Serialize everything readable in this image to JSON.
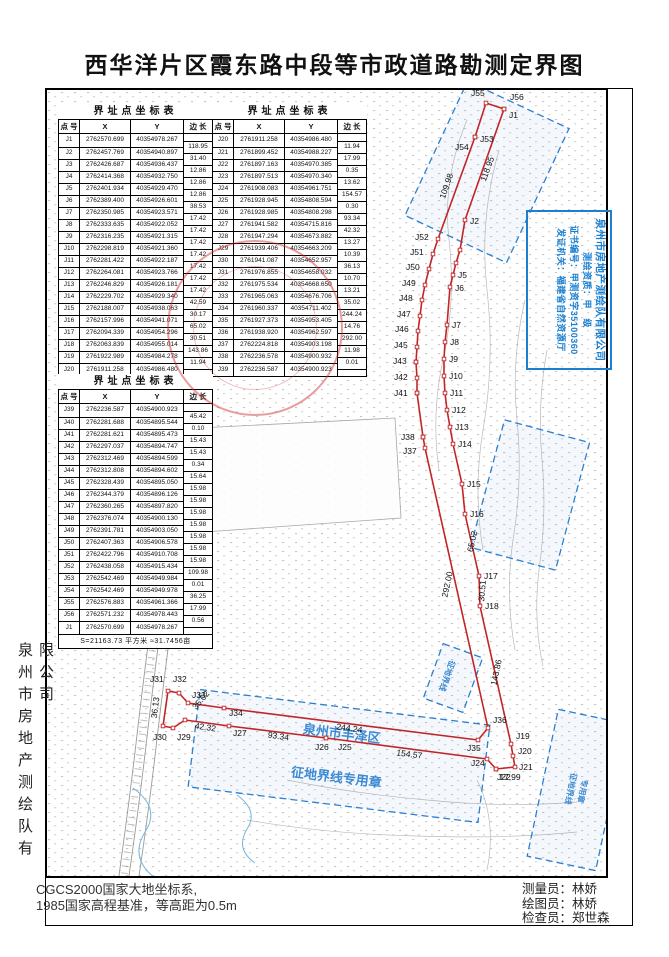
{
  "title": "西华洋片区霞东路中段等市政道路勘测定界图",
  "side_company": "泉州市房地产测绘队有限公司",
  "footnotes": [
    "CGCS2000国家大地坐标系,",
    "1985国家高程基准，等高距为0.5m"
  ],
  "credits": [
    {
      "label": "测量员",
      "name": "林娇"
    },
    {
      "label": "绘图员",
      "name": "林娇"
    },
    {
      "label": "检查员",
      "name": "郑世森"
    }
  ],
  "credits_sep": "：",
  "license_stamp": {
    "company": "泉州市房地产测绘队有限公司",
    "lines": [
      "测绘资质：甲　级",
      "证书编号：甲测资字35100360",
      "发证机关：福建省自然资源厅"
    ],
    "color": "#1a7fd0"
  },
  "tables": [
    {
      "title": "界址点坐标表",
      "headers": [
        "点 号",
        "X",
        "Y",
        "边 长"
      ],
      "points": [
        [
          "J1",
          "2762570.699",
          "40354978.267"
        ],
        [
          "J2",
          "2762457.769",
          "40354940.897"
        ],
        [
          "J3",
          "2762426.687",
          "40354936.437"
        ],
        [
          "J4",
          "2762414.368",
          "40354932.750"
        ],
        [
          "J5",
          "2762401.934",
          "40354929.470"
        ],
        [
          "J6",
          "2762389.400",
          "40354926.601"
        ],
        [
          "J7",
          "2762350.985",
          "40354923.571"
        ],
        [
          "J8",
          "2762333.635",
          "40354922.052"
        ],
        [
          "J9",
          "2762316.235",
          "40354921.315"
        ],
        [
          "J10",
          "2762298.819",
          "40354921.360"
        ],
        [
          "J11",
          "2762281.422",
          "40354922.187"
        ],
        [
          "J12",
          "2762264.081",
          "40354923.766"
        ],
        [
          "J13",
          "2762246.829",
          "40354926.181"
        ],
        [
          "J14",
          "2762229.702",
          "40354929.340"
        ],
        [
          "J15",
          "2762188.007",
          "40354938.063"
        ],
        [
          "J16",
          "2762157.996",
          "40354941.071"
        ],
        [
          "J17",
          "2762094.339",
          "40354954.296"
        ],
        [
          "J18",
          "2762063.839",
          "40354955.014"
        ],
        [
          "J19",
          "2761922.989",
          "40354984.278"
        ],
        [
          "J20",
          "2761911.258",
          "40354986.480"
        ]
      ],
      "lengths": [
        "118.95",
        "31.40",
        "12.86",
        "12.86",
        "12.86",
        "38.53",
        "17.42",
        "17.42",
        "17.42",
        "17.42",
        "17.42",
        "17.42",
        "17.42",
        "42.59",
        "30.17",
        "65.02",
        "30.51",
        "143.86",
        "11.94"
      ]
    },
    {
      "title": "界址点坐标表",
      "headers": [
        "点 号",
        "X",
        "Y",
        "边 长"
      ],
      "points": [
        [
          "J20",
          "2761911.258",
          "40354986.480"
        ],
        [
          "J21",
          "2761899.452",
          "40354988.227"
        ],
        [
          "J22",
          "2761897.163",
          "40354970.385"
        ],
        [
          "J23",
          "2761897.513",
          "40354970.340"
        ],
        [
          "J24",
          "2761908.083",
          "40354961.751"
        ],
        [
          "J25",
          "2761928.945",
          "40354808.594"
        ],
        [
          "J26",
          "2761928.985",
          "40354808.298"
        ],
        [
          "J27",
          "2761941.582",
          "40354715.816"
        ],
        [
          "J28",
          "2761947.294",
          "40354673.882"
        ],
        [
          "J29",
          "2761939.406",
          "40354663.209"
        ],
        [
          "J30",
          "2761941.087",
          "40354652.957"
        ],
        [
          "J31",
          "2761976.855",
          "40354658.032"
        ],
        [
          "J32",
          "2761975.534",
          "40354668.650"
        ],
        [
          "J33",
          "2761965.063",
          "40354676.706"
        ],
        [
          "J34",
          "2761960.337",
          "40354711.402"
        ],
        [
          "J35",
          "2761927.373",
          "40354953.405"
        ],
        [
          "J36",
          "2761938.920",
          "40354962.597"
        ],
        [
          "J37",
          "2762224.818",
          "40354903.198"
        ],
        [
          "J38",
          "2762236.578",
          "40354900.932"
        ],
        [
          "J39",
          "2762236.587",
          "40354900.923"
        ]
      ],
      "lengths": [
        "11.94",
        "17.99",
        "0.35",
        "13.62",
        "154.57",
        "0.30",
        "93.34",
        "42.32",
        "13.27",
        "10.39",
        "36.13",
        "10.70",
        "13.21",
        "35.02",
        "244.24",
        "14.76",
        "292.00",
        "11.98",
        "0.01"
      ]
    },
    {
      "title": "界址点坐标表",
      "headers": [
        "点 号",
        "X",
        "Y",
        "边 长"
      ],
      "points": [
        [
          "J39",
          "2762236.587",
          "40354900.923"
        ],
        [
          "J40",
          "2762281.688",
          "40354895.544"
        ],
        [
          "J41",
          "2762281.621",
          "40354895.473"
        ],
        [
          "J42",
          "2762297.037",
          "40354894.747"
        ],
        [
          "J43",
          "2762312.469",
          "40354894.599"
        ],
        [
          "J44",
          "2762312.808",
          "40354894.602"
        ],
        [
          "J45",
          "2762328.439",
          "40354895.050"
        ],
        [
          "J46",
          "2762344.379",
          "40354896.126"
        ],
        [
          "J47",
          "2762360.265",
          "40354897.820"
        ],
        [
          "J48",
          "2762376.074",
          "40354900.130"
        ],
        [
          "J49",
          "2762391.781",
          "40354903.050"
        ],
        [
          "J50",
          "2762407.363",
          "40354906.578"
        ],
        [
          "J51",
          "2762422.796",
          "40354910.708"
        ],
        [
          "J52",
          "2762438.058",
          "40354915.434"
        ],
        [
          "J53",
          "2762542.469",
          "40354949.984"
        ],
        [
          "J54",
          "2762542.469",
          "40354949.978"
        ],
        [
          "J55",
          "2762576.883",
          "40354961.366"
        ],
        [
          "J56",
          "2762571.232",
          "40354978.443"
        ],
        [
          "J1",
          "2762570.699",
          "40354978.267"
        ]
      ],
      "lengths": [
        "45.42",
        "0.10",
        "15.43",
        "15.43",
        "0.34",
        "15.64",
        "15.98",
        "15.98",
        "15.98",
        "15.98",
        "15.98",
        "15.98",
        "15.98",
        "109.98",
        "0.01",
        "36.25",
        "17.99",
        "0.56"
      ],
      "footer": "S=21163.73 平方米 ≈31.7456亩"
    }
  ],
  "map": {
    "boundary_color": "#c22527",
    "outline": [
      [
        "J1",
        457,
        19
      ],
      [
        "J2",
        418,
        130
      ],
      [
        "J3",
        413,
        160
      ],
      [
        "J4",
        409,
        173
      ],
      [
        "J5",
        406,
        185
      ],
      [
        "J6",
        403,
        197
      ],
      [
        "J7",
        400,
        235
      ],
      [
        "J8",
        398,
        252
      ],
      [
        "J9",
        397,
        269
      ],
      [
        "J10",
        397,
        286
      ],
      [
        "J11",
        398,
        303
      ],
      [
        "J12",
        400,
        320
      ],
      [
        "J13",
        403,
        337
      ],
      [
        "J14",
        406,
        354
      ],
      [
        "J15",
        415,
        394
      ],
      [
        "J16",
        418,
        424
      ],
      [
        "J17",
        432,
        486
      ],
      [
        "J18",
        433,
        516
      ],
      [
        "J19",
        464,
        654
      ],
      [
        "J20",
        466,
        666
      ],
      [
        "J21",
        468,
        677
      ],
      [
        "J22",
        449,
        679
      ],
      [
        "J23",
        449,
        679
      ],
      [
        "J24",
        440,
        669
      ],
      [
        "J25",
        279,
        648
      ],
      [
        "J26",
        279,
        648
      ],
      [
        "J27",
        182,
        636
      ],
      [
        "J28",
        138,
        630
      ],
      [
        "J29",
        126,
        638
      ],
      [
        "J30",
        116,
        636
      ],
      [
        "J31",
        121,
        601
      ],
      [
        "J32",
        132,
        603
      ],
      [
        "J33",
        141,
        613
      ],
      [
        "J34",
        177,
        618
      ],
      [
        "J35",
        431,
        650
      ],
      [
        "J36",
        441,
        638
      ],
      [
        "J37",
        378,
        358
      ],
      [
        "J38",
        376,
        347
      ],
      [
        "J39",
        376,
        347
      ],
      [
        "J40",
        370,
        303
      ],
      [
        "J41",
        370,
        303
      ],
      [
        "J42",
        370,
        288
      ],
      [
        "J43",
        369,
        272
      ],
      [
        "J44",
        369,
        272
      ],
      [
        "J45",
        370,
        257
      ],
      [
        "J46",
        371,
        241
      ],
      [
        "J47",
        373,
        226
      ],
      [
        "J48",
        375,
        210
      ],
      [
        "J49",
        378,
        195
      ],
      [
        "J50",
        382,
        179
      ],
      [
        "J51",
        386,
        164
      ],
      [
        "J52",
        391,
        149
      ],
      [
        "J53",
        428,
        47
      ],
      [
        "J54",
        428,
        47
      ],
      [
        "J55",
        439,
        13
      ],
      [
        "J56",
        457,
        19
      ]
    ],
    "point_labels": [
      [
        "J1",
        462,
        28
      ],
      [
        "J2",
        423,
        134
      ],
      [
        "J5",
        411,
        188
      ],
      [
        "J6",
        408,
        201
      ],
      [
        "J7",
        405,
        238
      ],
      [
        "J8",
        403,
        255
      ],
      [
        "J9",
        402,
        272
      ],
      [
        "J10",
        402,
        289
      ],
      [
        "J11",
        403,
        306
      ],
      [
        "J12",
        405,
        323
      ],
      [
        "J13",
        408,
        340
      ],
      [
        "J14",
        411,
        357
      ],
      [
        "J15",
        420,
        397
      ],
      [
        "J16",
        423,
        427
      ],
      [
        "J17",
        437,
        489
      ],
      [
        "J18",
        438,
        519
      ],
      [
        "J19",
        469,
        649
      ],
      [
        "J20",
        471,
        664
      ],
      [
        "J21",
        472,
        680
      ],
      [
        "J22",
        450,
        690
      ],
      [
        "J24",
        424,
        676
      ],
      [
        "J25",
        291,
        660
      ],
      [
        "J26",
        268,
        660
      ],
      [
        "J27",
        186,
        646
      ],
      [
        "J29",
        130,
        650
      ],
      [
        "J30",
        106,
        650
      ],
      [
        "J31",
        103,
        592
      ],
      [
        "J32",
        126,
        592
      ],
      [
        "J33",
        145,
        608
      ],
      [
        "J34",
        182,
        626
      ],
      [
        "J35",
        420,
        661
      ],
      [
        "J36",
        446,
        633
      ],
      [
        "J37",
        356,
        364
      ],
      [
        "J38",
        354,
        350
      ],
      [
        "J41",
        347,
        306
      ],
      [
        "J42",
        347,
        290
      ],
      [
        "J43",
        346,
        274
      ],
      [
        "J45",
        347,
        258
      ],
      [
        "J46",
        348,
        242
      ],
      [
        "J47",
        350,
        227
      ],
      [
        "J48",
        352,
        211
      ],
      [
        "J49",
        355,
        196
      ],
      [
        "J50",
        359,
        180
      ],
      [
        "J51",
        363,
        165
      ],
      [
        "J52",
        368,
        150
      ],
      [
        "J53",
        433,
        52
      ],
      [
        "J54",
        408,
        60
      ],
      [
        "J55",
        424,
        6
      ],
      [
        "J56",
        463,
        10
      ]
    ],
    "segment_labels": [
      [
        "118.95",
        443,
        80,
        -70
      ],
      [
        "109.98",
        402,
        97,
        -71
      ],
      [
        "65.02",
        428,
        452,
        -78
      ],
      [
        "30.51",
        438,
        501,
        -85
      ],
      [
        "143.86",
        452,
        583,
        -78
      ],
      [
        "292.00",
        403,
        495,
        -78
      ],
      [
        "244.24",
        302,
        641,
        8
      ],
      [
        "154.57",
        362,
        667,
        7
      ],
      [
        "93.34",
        231,
        649,
        8
      ],
      [
        "42.32",
        158,
        640,
        8
      ],
      [
        "36.13",
        111,
        618,
        -83
      ],
      [
        "17.99",
        463,
        690,
        0
      ],
      [
        "35.02",
        156,
        612,
        -50
      ]
    ],
    "blue_stamps": [
      {
        "x": 440,
        "y": 82,
        "w": 112,
        "h": 148,
        "rot": 25,
        "lines": []
      },
      {
        "x": 483,
        "y": 405,
        "w": 88,
        "h": 132,
        "rot": 15,
        "lines": []
      },
      {
        "x": 292,
        "y": 666,
        "w": 292,
        "h": 98,
        "rot": 7,
        "lines": [
          "泉州市丰泽区",
          "征地界线专用章"
        ]
      },
      {
        "x": 406,
        "y": 588,
        "w": 42,
        "h": 58,
        "rot": 20,
        "lines": [
          "征地界线"
        ],
        "vertical": true
      },
      {
        "x": 530,
        "y": 700,
        "w": 70,
        "h": 150,
        "rot": 12,
        "lines": [
          "征地界线",
          "专用章"
        ],
        "vertical": true
      }
    ],
    "stamp_color": "#2a7fd0"
  }
}
